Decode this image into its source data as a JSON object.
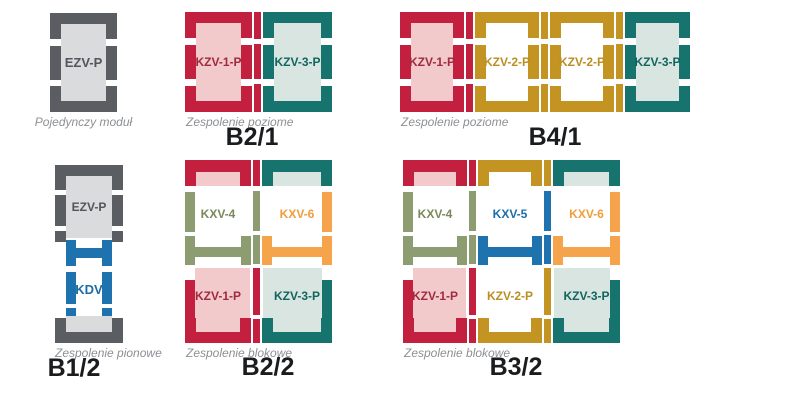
{
  "palette": {
    "red": {
      "frame": "#c2203e",
      "fill": "#f2cacc",
      "text": "#a12a3e"
    },
    "teal": {
      "frame": "#17736d",
      "fill": "#d9e5e1",
      "text": "#10655f"
    },
    "gold": {
      "frame": "#c39422",
      "fill": "#ffffff",
      "text": "#ba8e20"
    },
    "gray": {
      "frame": "#5a5e62",
      "fill": "#d9dbdc",
      "text": "#50565b"
    },
    "olive": {
      "frame": "#8d9c71",
      "fill": "#ffffff",
      "text": "#79895c"
    },
    "orange": {
      "frame": "#f5a44b",
      "fill": "#ffffff",
      "text": "#f09d3c"
    },
    "blue": {
      "frame": "#1e73ae",
      "fill": "#ffffff",
      "text": "#1b6da7"
    }
  },
  "text_colors": {
    "caption": "#8c9094",
    "label": "#1b1c1e"
  },
  "diagrams": [
    {
      "id": "single",
      "type": "single",
      "caption": "Pojedynczy moduł",
      "label": "",
      "modules": [
        {
          "name": "EZV-P",
          "color": "gray"
        }
      ]
    },
    {
      "id": "b21",
      "type": "horizontal",
      "caption": "Zespolenie poziome",
      "label": "B2/1",
      "modules": [
        {
          "name": "KZV-1-P",
          "color": "red"
        },
        {
          "name": "KZV-3-P",
          "color": "teal"
        }
      ]
    },
    {
      "id": "b41",
      "type": "horizontal",
      "caption": "Zespolenie poziome",
      "label": "B4/1",
      "modules": [
        {
          "name": "KZV-1-P",
          "color": "red"
        },
        {
          "name": "KZV-2-P",
          "color": "gold"
        },
        {
          "name": "KZV-2-P",
          "color": "gold"
        },
        {
          "name": "KZV-3-P",
          "color": "teal"
        }
      ]
    },
    {
      "id": "b12",
      "type": "vertical",
      "caption": "Zespolenie pionowe",
      "label": "B1/2",
      "modules": [
        {
          "name": "EZV-P",
          "color": "gray"
        },
        {
          "name": "KDV",
          "color": "blue"
        }
      ]
    },
    {
      "id": "b22",
      "type": "block",
      "caption": "Zespolenie blokowe",
      "label": "B2/2",
      "columns": [
        {
          "top": {
            "name": "KXV-4",
            "color": "olive"
          },
          "bottom": {
            "name": "KZV-1-P",
            "color": "red"
          }
        },
        {
          "top": {
            "name": "KXV-6",
            "color": "orange"
          },
          "bottom": {
            "name": "KZV-3-P",
            "color": "teal"
          }
        }
      ]
    },
    {
      "id": "b32",
      "type": "block",
      "caption": "Zespolenie blokowe",
      "label": "B3/2",
      "columns": [
        {
          "top": {
            "name": "KXV-4",
            "color": "olive"
          },
          "bottom": {
            "name": "KZV-1-P",
            "color": "red"
          }
        },
        {
          "top": {
            "name": "KXV-5",
            "color": "blue"
          },
          "bottom": {
            "name": "KZV-2-P",
            "color": "gold"
          }
        },
        {
          "top": {
            "name": "KXV-6",
            "color": "orange"
          },
          "bottom": {
            "name": "KZV-3-P",
            "color": "teal"
          }
        }
      ]
    }
  ]
}
